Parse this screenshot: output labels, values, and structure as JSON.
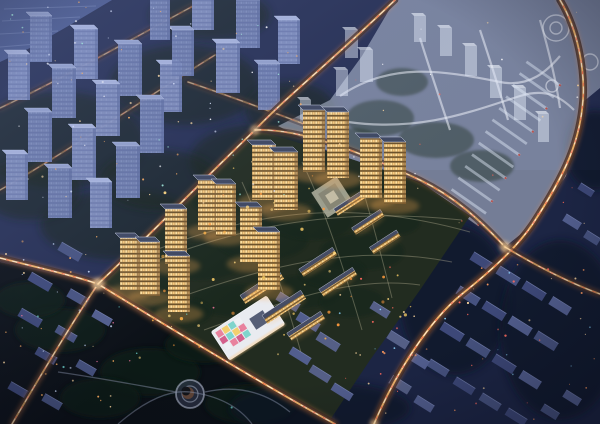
{
  "scene": {
    "viewBox": "0 0 600 424",
    "width": 600,
    "height": 424
  },
  "palette": {
    "base": "#252e52",
    "hazeTop": "#8a9ad0",
    "water": "#4a5a8e",
    "waterStreak": "#8494c2",
    "parkGround": "#0b1016",
    "rightGround": "#1b2342",
    "devGround": "#222c20",
    "treeDark": "#122017",
    "parkTree": "#101a12",
    "ghostFill": "#c6cfe2",
    "ghostRoad": "#eef2fa",
    "ghostTower": "#dde6f4",
    "ghostTowerCap": "#f4f8ff",
    "towerFacade": "#c69e5e",
    "towerSide": "#7c5a30",
    "towerRoof": "#3e4760",
    "towerRoofRim": "#c9d0e2",
    "towerGlow": "#ffae54",
    "slabRoof": "#454c64",
    "slabRim": "#cdd3e2",
    "slabFacade": "#c79f5f",
    "blueFacades": [
      "#7180b0",
      "#8290c0"
    ],
    "blueCaps": [
      "#93a1cc",
      "#a8b4dc"
    ],
    "blueSide": "#5c6a9c",
    "blockColors": [
      "#3d4878",
      "#46527f",
      "#525e8e",
      "#555f86"
    ],
    "blockTop": "#7d89b8",
    "roadBase": "#0a1020",
    "roadGlow": "#ff9040",
    "roadAmber": "#ffc272",
    "roadCore": "#fff3df",
    "roadRed": "#ff4f42",
    "plazaOuter": "#a7a896",
    "plazaMid": "#868472",
    "plazaInner": "#c9c2a8",
    "kgBody": "#e9ebf0",
    "kgRim": "#f6f8fc",
    "kgNotch": "#565e76",
    "kgGlow": "#ffce8e",
    "pathLight": "#d9cfae",
    "parkPath": "#8a94ac",
    "ringColor": "#aab2c6",
    "crescent": "#6b4a38",
    "vignette": "rgba(8,10,24,0.40)"
  },
  "water": {
    "poly": "0,0 112,0 70,25 30,48 0,62",
    "streaks": [
      [
        4,
        9,
        96,
        6
      ],
      [
        2,
        21,
        80,
        17
      ],
      [
        0,
        34,
        58,
        31
      ],
      [
        0,
        47,
        36,
        44
      ]
    ]
  },
  "bgTrees": [
    [
      60,
      140,
      85,
      48
    ],
    [
      185,
      85,
      75,
      40
    ],
    [
      255,
      160,
      65,
      35
    ],
    [
      120,
      225,
      80,
      35
    ],
    [
      30,
      190,
      50,
      30
    ],
    [
      210,
      15,
      60,
      25
    ],
    [
      290,
      110,
      45,
      28
    ],
    [
      160,
      180,
      60,
      30
    ]
  ],
  "rightTrees": [
    [
      455,
      300,
      55,
      75
    ],
    [
      560,
      330,
      60,
      90
    ],
    [
      320,
      408,
      90,
      26
    ],
    [
      595,
      150,
      30,
      40
    ]
  ],
  "bgTowers": [
    [
      30,
      62,
      22,
      46,
      0
    ],
    [
      74,
      79,
      24,
      50,
      1
    ],
    [
      118,
      96,
      24,
      52,
      0
    ],
    [
      160,
      112,
      22,
      48,
      1
    ],
    [
      8,
      100,
      22,
      46,
      1
    ],
    [
      52,
      118,
      24,
      50,
      0
    ],
    [
      96,
      136,
      24,
      52,
      1
    ],
    [
      140,
      153,
      24,
      54,
      0
    ],
    [
      28,
      162,
      24,
      50,
      0
    ],
    [
      72,
      180,
      24,
      52,
      1
    ],
    [
      116,
      198,
      24,
      52,
      0
    ],
    [
      6,
      200,
      22,
      46,
      1
    ],
    [
      48,
      218,
      24,
      50,
      0
    ],
    [
      192,
      30,
      22,
      44,
      1
    ],
    [
      236,
      48,
      24,
      48,
      0
    ],
    [
      278,
      64,
      22,
      44,
      1
    ],
    [
      172,
      76,
      22,
      46,
      0
    ],
    [
      216,
      93,
      24,
      50,
      1
    ],
    [
      258,
      110,
      22,
      46,
      0
    ],
    [
      150,
      40,
      20,
      42,
      0
    ],
    [
      90,
      228,
      22,
      46,
      1
    ]
  ],
  "bgRoads": [
    {
      "d": "M0,108 C60,80 130,40 195,5",
      "w": 2,
      "lv": 0.4
    },
    {
      "d": "M0,190 C70,150 150,95 215,55",
      "w": 2,
      "lv": 0.4
    },
    {
      "d": "M188,82 C230,96 272,112 312,127",
      "w": 2,
      "lv": 0.45
    }
  ],
  "ghost": {
    "poly": "395,0 600,0 600,88 583,102 566,176 532,225 505,247 470,216 420,182 330,152 278,126 330,100 362,56",
    "roads": [
      "M340,96 C390,62 440,70 500,82 C530,88 548,70 560,56",
      "M348,122 C420,132 470,112 520,96 C545,88 560,96 574,110",
      "M420,38 C430,70 440,100 450,130",
      "M480,30 C490,60 500,92 508,120",
      "M540,20 C548,48 556,80 560,108"
    ],
    "courts": [
      [
        380,
        118,
        34,
        18
      ],
      [
        436,
        140,
        38,
        18
      ],
      [
        482,
        166,
        32,
        16
      ],
      [
        402,
        82,
        26,
        14
      ],
      [
        355,
        140,
        24,
        12
      ]
    ],
    "circles": [
      [
        556,
        28,
        13
      ],
      [
        556,
        28,
        6
      ],
      [
        590,
        62,
        8
      ],
      [
        552,
        86,
        6
      ]
    ],
    "towers": [
      [
        345,
        58,
        13,
        28
      ],
      [
        360,
        82,
        13,
        32
      ],
      [
        336,
        96,
        12,
        26
      ],
      [
        414,
        42,
        12,
        26
      ],
      [
        440,
        56,
        12,
        28
      ],
      [
        465,
        76,
        12,
        30
      ],
      [
        490,
        98,
        12,
        30
      ],
      [
        514,
        120,
        12,
        32
      ],
      [
        300,
        122,
        11,
        22
      ],
      [
        538,
        142,
        11,
        28
      ]
    ],
    "comb": {
      "x": 462,
      "y": 213,
      "dx": 6.8,
      "dy": -11.6,
      "n": 13,
      "len": 42,
      "th": 2.8,
      "rot": 35
    }
  },
  "districtBlocks": [
    [
      482,
      262,
      24,
      9,
      32,
      0
    ],
    [
      508,
      276,
      24,
      9,
      32,
      1
    ],
    [
      534,
      291,
      24,
      9,
      32,
      0
    ],
    [
      560,
      306,
      22,
      9,
      32,
      2
    ],
    [
      468,
      296,
      24,
      9,
      32,
      1
    ],
    [
      494,
      311,
      24,
      9,
      32,
      0
    ],
    [
      520,
      326,
      24,
      9,
      32,
      2
    ],
    [
      546,
      341,
      24,
      9,
      32,
      1
    ],
    [
      452,
      332,
      24,
      9,
      32,
      0
    ],
    [
      478,
      348,
      24,
      9,
      32,
      1
    ],
    [
      504,
      364,
      24,
      9,
      32,
      0
    ],
    [
      530,
      380,
      22,
      9,
      32,
      2
    ],
    [
      438,
      368,
      22,
      8,
      32,
      1
    ],
    [
      464,
      386,
      22,
      8,
      32,
      0
    ],
    [
      490,
      402,
      22,
      8,
      32,
      1
    ],
    [
      516,
      417,
      22,
      8,
      32,
      0
    ],
    [
      572,
      222,
      18,
      8,
      32,
      2
    ],
    [
      592,
      238,
      16,
      8,
      32,
      1
    ],
    [
      586,
      190,
      16,
      7,
      32,
      0
    ],
    [
      572,
      398,
      18,
      8,
      32,
      2
    ],
    [
      550,
      412,
      18,
      8,
      32,
      1
    ],
    [
      398,
      340,
      22,
      9,
      32,
      3
    ],
    [
      418,
      360,
      22,
      9,
      32,
      2
    ],
    [
      400,
      385,
      22,
      9,
      32,
      3
    ],
    [
      424,
      404,
      20,
      8,
      32,
      2
    ],
    [
      380,
      310,
      20,
      8,
      32,
      3
    ],
    [
      288,
      302,
      24,
      9,
      32,
      3
    ],
    [
      308,
      322,
      24,
      9,
      32,
      2
    ],
    [
      328,
      342,
      24,
      9,
      32,
      3
    ],
    [
      300,
      356,
      22,
      8,
      32,
      2
    ],
    [
      320,
      374,
      22,
      8,
      32,
      3
    ],
    [
      342,
      392,
      22,
      8,
      32,
      2
    ],
    [
      70,
      252,
      24,
      9,
      30,
      1
    ],
    [
      40,
      282,
      24,
      9,
      30,
      0
    ],
    [
      78,
      298,
      22,
      9,
      30,
      1
    ],
    [
      30,
      318,
      24,
      9,
      30,
      0
    ],
    [
      66,
      334,
      22,
      8,
      30,
      1
    ],
    [
      102,
      318,
      20,
      8,
      30,
      2
    ],
    [
      46,
      356,
      22,
      8,
      30,
      0
    ],
    [
      86,
      368,
      20,
      8,
      30,
      1
    ],
    [
      18,
      390,
      20,
      8,
      30,
      0
    ],
    [
      52,
      402,
      20,
      8,
      30,
      1
    ]
  ],
  "park": {
    "poly": "0,262 98,284 200,346 330,424 0,424",
    "blobs": [
      [
        60,
        330,
        45,
        22
      ],
      [
        150,
        372,
        50,
        24
      ],
      [
        250,
        404,
        45,
        20
      ],
      [
        100,
        398,
        40,
        20
      ],
      [
        205,
        345,
        40,
        18
      ],
      [
        30,
        300,
        35,
        18
      ]
    ],
    "ring": [
      190,
      394,
      14,
      8
    ],
    "crescent": [
      188,
      393,
      6
    ],
    "paths": [
      "M118,424 C148,398 172,390 190,392 C220,396 240,408 252,424",
      "M58,372 C100,378 142,386 176,392",
      "M205,392 C240,384 268,394 290,412"
    ]
  },
  "roads": [
    {
      "d": "M12,424 C45,368 75,318 98,284",
      "w": 2.6,
      "lv": 0.75
    },
    {
      "d": "M0,258 C40,268 75,276 98,284 C160,322 262,384 335,424",
      "w": 3,
      "lv": 1
    },
    {
      "d": "M98,284 C150,235 205,178 255,130 C285,98 335,58 395,0",
      "w": 2.6,
      "lv": 0.95
    },
    {
      "d": "M255,130 C300,128 360,152 420,180 C455,197 480,220 505,247",
      "w": 2.4,
      "lv": 0.8
    },
    {
      "d": "M560,0 C578,30 585,70 583,100 C580,140 567,172 532,225 C516,248 492,270 462,294 C430,320 396,372 374,424",
      "w": 3.4,
      "lv": 1
    },
    {
      "d": "M505,247 C530,262 562,280 600,294",
      "w": 2.4,
      "lv": 0.7
    }
  ],
  "glowBlobs": [
    [
      98,
      284,
      6
    ],
    [
      255,
      130,
      4
    ],
    [
      505,
      247,
      5
    ],
    [
      374,
      424,
      4
    ],
    [
      312,
      127,
      3
    ]
  ],
  "devSite": {
    "poly": "98,284 255,130 330,152 420,182 470,216 420,290 370,360 330,420",
    "greens": [
      [
        200,
        262,
        42,
        18
      ],
      [
        262,
        240,
        46,
        20
      ],
      [
        312,
        222,
        40,
        18
      ],
      [
        362,
        252,
        42,
        18
      ],
      [
        232,
        300,
        40,
        16
      ],
      [
        302,
        292,
        38,
        16
      ],
      [
        182,
        312,
        30,
        14
      ],
      [
        352,
        302,
        32,
        15
      ],
      [
        392,
        222,
        28,
        13
      ],
      [
        282,
        192,
        34,
        15
      ],
      [
        222,
        202,
        30,
        13
      ],
      [
        332,
        272,
        34,
        15
      ],
      [
        372,
        195,
        30,
        13
      ],
      [
        160,
        290,
        26,
        12
      ]
    ],
    "paths": [
      "M128,272 C230,228 330,206 462,220",
      "M150,252 C250,214 340,196 470,232",
      "M172,300 C262,268 352,242 452,262",
      "M204,330 C282,302 352,275 420,285",
      "M242,182 C262,226 282,286 302,356",
      "M302,162 C322,202 342,262 362,330",
      "M360,180 C372,220 382,258 392,298"
    ],
    "plaza": {
      "cx": 332,
      "cy": 197,
      "rot": -33,
      "sizes": [
        30,
        20,
        10
      ]
    },
    "slabs": [
      [
        350,
        203,
        34,
        8,
        -33
      ],
      [
        368,
        222,
        34,
        8,
        -33
      ],
      [
        385,
        242,
        32,
        8,
        -33
      ],
      [
        318,
        262,
        40,
        9,
        -33
      ],
      [
        338,
        282,
        40,
        9,
        -33
      ],
      [
        262,
        287,
        46,
        10,
        -33
      ],
      [
        284,
        307,
        46,
        10,
        -33
      ],
      [
        306,
        326,
        40,
        9,
        -33
      ]
    ],
    "towers": [
      [
        303,
        172,
        22,
        62
      ],
      [
        327,
        178,
        22,
        66
      ],
      [
        360,
        198,
        22,
        60
      ],
      [
        384,
        204,
        22,
        62
      ],
      [
        252,
        200,
        24,
        55
      ],
      [
        274,
        210,
        24,
        58
      ],
      [
        198,
        230,
        20,
        50
      ],
      [
        216,
        236,
        20,
        52
      ],
      [
        165,
        264,
        22,
        55
      ],
      [
        120,
        290,
        20,
        52
      ],
      [
        140,
        296,
        20,
        54
      ],
      [
        168,
        312,
        22,
        56
      ],
      [
        240,
        262,
        22,
        55
      ],
      [
        258,
        290,
        22,
        58
      ]
    ],
    "kindergarten": {
      "cx": 248,
      "cy": 328,
      "rot": -33,
      "w": 66,
      "h": 34,
      "cell": 7.5,
      "cols": 4,
      "rows": 3,
      "colors": [
        "#e8829e",
        "#f3cf6e",
        "#7fd4cc",
        "#eef0f4",
        "#d4608c",
        "#7fd4cc",
        "#f3cf6e",
        "#e8829e",
        "#eef0f4",
        "#e8829e",
        "#d4608c",
        "#7fd4cc"
      ]
    }
  },
  "dotFields": [
    {
      "x": 2,
      "y": 2,
      "w": 300,
      "h": 216,
      "n": 85,
      "rmin": 0.5,
      "rmax": 1.1,
      "colors": [
        "#ffd9a0",
        "#ffae5e",
        "#dfe8ff",
        "#9fe8d8",
        "#ffffff"
      ],
      "seed": 7
    },
    {
      "x": 335,
      "y": 245,
      "w": 262,
      "h": 176,
      "n": 60,
      "rmin": 0.5,
      "rmax": 1.2,
      "colors": [
        "#ffd9a0",
        "#ff9a5e",
        "#8fd8ff",
        "#ff6a5e"
      ],
      "seed": 11
    },
    {
      "x": 2,
      "y": 235,
      "w": 112,
      "h": 185,
      "n": 34,
      "rmin": 0.5,
      "rmax": 1.1,
      "colors": [
        "#ffd9a0",
        "#ffae5e",
        "#cfe0ff"
      ],
      "seed": 23
    },
    {
      "x": 338,
      "y": 6,
      "w": 248,
      "h": 230,
      "n": 26,
      "rmin": 0.4,
      "rmax": 1.0,
      "colors": [
        "#ffffff",
        "#ffd9a0",
        "#ff6655"
      ],
      "seed": 31
    },
    {
      "x": 150,
      "y": 155,
      "w": 270,
      "h": 195,
      "n": 46,
      "rmin": 0.7,
      "rmax": 1.7,
      "colors": [
        "#ffb347",
        "#ffd87e",
        "#ff9a3d",
        "#e8c060"
      ],
      "seed": 43
    },
    {
      "x": 20,
      "y": 300,
      "w": 270,
      "h": 115,
      "n": 16,
      "rmin": 0.6,
      "rmax": 1.2,
      "colors": [
        "#ffd87e",
        "#6fd8d0",
        "#e8729a"
      ],
      "seed": 53
    }
  ]
}
